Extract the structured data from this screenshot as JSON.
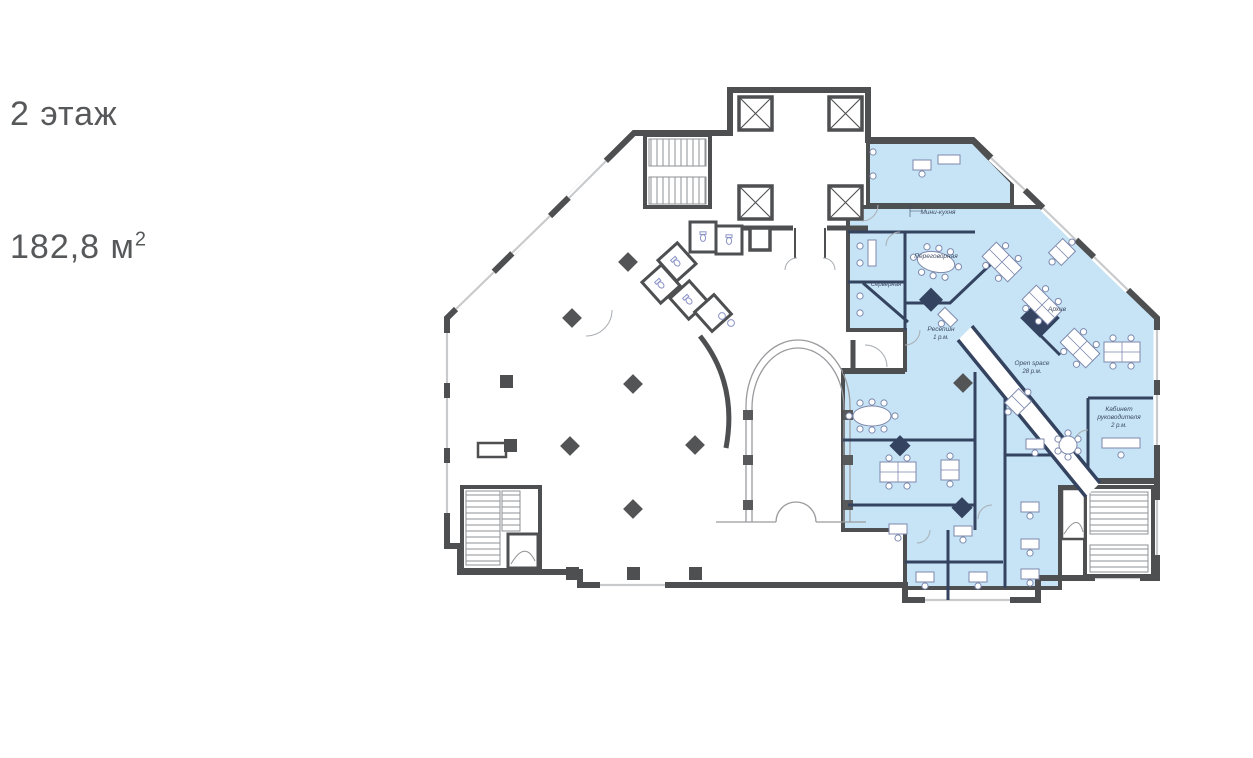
{
  "title": {
    "floor": "2 этаж",
    "area_base": "182,8 м",
    "area_exponent": "2"
  },
  "colors": {
    "highlight_fill": "#c6e4f5",
    "wall": "#4e4f51",
    "partition": "#34435f",
    "furniture": "#7d89ad",
    "fixture": "#8b93c8",
    "label_text": "#3d4961",
    "title_text": "#57585a",
    "window": "#c9cacc"
  },
  "rooms": {
    "mini_kitchen": {
      "label": "Мини-кухня"
    },
    "meeting_room": {
      "label": "Переговорная"
    },
    "server_room": {
      "label": "Серверная"
    },
    "reception": {
      "label": "Ресепшн",
      "capacity": "1 р.м."
    },
    "archive": {
      "label": "Архив"
    },
    "open_space": {
      "label": "Open space",
      "capacity": "28 р.м."
    },
    "head_office": {
      "label_line1": "Кабинет",
      "label_line2": "руководителя",
      "capacity": "2 р.м."
    }
  }
}
